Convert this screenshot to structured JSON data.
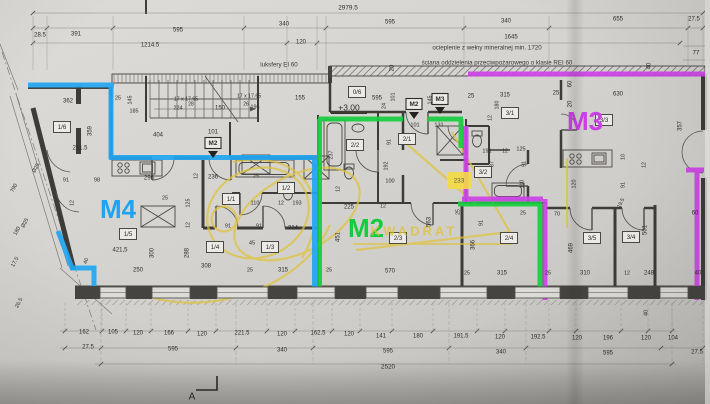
{
  "plan": {
    "colors": {
      "m4": "#1ea4f3",
      "m2": "#14cb3e",
      "m3": "#cb3fe6",
      "watermark": "#dfc33c",
      "highlight_fill": "#f4da45",
      "ink": "#2e2d2a"
    },
    "apartments": [
      {
        "t": "M4",
        "x": 118,
        "y": 211,
        "c": "#1ea4f3"
      },
      {
        "t": "M2",
        "x": 366,
        "y": 230,
        "c": "#14cb3e"
      },
      {
        "t": "M3",
        "x": 585,
        "y": 123,
        "c": "#cb3fe6"
      }
    ],
    "exit_markers": [
      {
        "t": "M2",
        "x": 213,
        "y": 143
      },
      {
        "t": "M2",
        "x": 414,
        "y": 104
      },
      {
        "t": "M3",
        "x": 440,
        "y": 99
      }
    ],
    "room_labels": [
      {
        "t": "1/6",
        "x": 62,
        "y": 127
      },
      {
        "t": "0/6",
        "x": 357,
        "y": 92
      },
      {
        "t": "2/2",
        "x": 355,
        "y": 145
      },
      {
        "t": "2/1",
        "x": 407,
        "y": 139
      },
      {
        "t": "3/1",
        "x": 510,
        "y": 113
      },
      {
        "t": "3/3",
        "x": 604,
        "y": 120
      },
      {
        "t": "3/2",
        "x": 483,
        "y": 172
      },
      {
        "t": "1/2",
        "x": 286,
        "y": 188
      },
      {
        "t": "1/1",
        "x": 231,
        "y": 199
      },
      {
        "t": "1/5",
        "x": 128,
        "y": 234
      },
      {
        "t": "1/4",
        "x": 215,
        "y": 247
      },
      {
        "t": "1/3",
        "x": 270,
        "y": 247
      },
      {
        "t": "2/3",
        "x": 398,
        "y": 238
      },
      {
        "t": "2/4",
        "x": 509,
        "y": 238
      },
      {
        "t": "3/5",
        "x": 592,
        "y": 238
      },
      {
        "t": "3/4",
        "x": 631,
        "y": 237
      }
    ],
    "notes": [
      {
        "t": "ocieplenie z wełny mineralnej min. 1720",
        "x": 487,
        "y": 48
      },
      {
        "t": "ściana oddzielenia przeciwpożarowego o klasie  REI 60",
        "x": 497,
        "y": 63
      },
      {
        "t": "luksfery EI 60",
        "x": 279,
        "y": 65
      }
    ],
    "level_mark": {
      "t": "+3.00",
      "x": 349,
      "y": 108
    },
    "watermark_text": {
      "t": "KWADRAT",
      "x": 414,
      "y": 232
    },
    "highlight_box": {
      "t": "233",
      "x": 459,
      "y": 181
    },
    "section_marker": {
      "t": "A",
      "x": 192,
      "y": 397
    },
    "dimensions": [
      {
        "t": "2979.5",
        "x": 348,
        "y": 8,
        "s": 6.4
      },
      {
        "t": "28.5",
        "x": 40,
        "y": 35
      },
      {
        "t": "391",
        "x": 76,
        "y": 34
      },
      {
        "t": "595",
        "x": 178,
        "y": 30
      },
      {
        "t": "340",
        "x": 284,
        "y": 24
      },
      {
        "t": "595",
        "x": 390,
        "y": 22
      },
      {
        "t": "340",
        "x": 506,
        "y": 21
      },
      {
        "t": "655",
        "x": 618,
        "y": 19
      },
      {
        "t": "27.5",
        "x": 694,
        "y": 19
      },
      {
        "t": "1214.5",
        "x": 150,
        "y": 45
      },
      {
        "t": "120",
        "x": 301,
        "y": 42
      },
      {
        "t": "1645",
        "x": 511,
        "y": 37
      },
      {
        "t": "77",
        "x": 696,
        "y": 53
      },
      {
        "t": "20",
        "x": 392,
        "y": 68,
        "r": -90
      },
      {
        "t": "155",
        "x": 300,
        "y": 98
      },
      {
        "t": "17 x 17.65",
        "x": 186,
        "y": 99,
        "s": 5.2
      },
      {
        "t": "224",
        "x": 178,
        "y": 108,
        "s": 5.4
      },
      {
        "t": "28",
        "x": 191,
        "y": 104,
        "s": 5
      },
      {
        "t": "17 x 17.65",
        "x": 249,
        "y": 96,
        "s": 5.2
      },
      {
        "t": "26",
        "x": 246,
        "y": 104,
        "s": 5
      },
      {
        "t": "196",
        "x": 255,
        "y": 107,
        "s": 5.4
      },
      {
        "t": "150",
        "x": 220,
        "y": 108
      },
      {
        "t": "362",
        "x": 68,
        "y": 101
      },
      {
        "t": "25",
        "x": 118,
        "y": 98,
        "s": 5.4
      },
      {
        "t": "145",
        "x": 130,
        "y": 100,
        "r": -90,
        "s": 5.4
      },
      {
        "t": "185",
        "x": 134,
        "y": 111,
        "s": 5.4
      },
      {
        "t": "359",
        "x": 90,
        "y": 131,
        "r": -90
      },
      {
        "t": "261.5",
        "x": 80,
        "y": 148
      },
      {
        "t": "404",
        "x": 158,
        "y": 135
      },
      {
        "t": "101",
        "x": 213,
        "y": 132
      },
      {
        "t": "595",
        "x": 377,
        "y": 98
      },
      {
        "t": "24",
        "x": 384,
        "y": 106,
        "r": -90,
        "s": 5.4
      },
      {
        "t": "101",
        "x": 393,
        "y": 97,
        "r": -90,
        "s": 5.4
      },
      {
        "t": "145",
        "x": 430,
        "y": 100,
        "r": -90,
        "s": 5.4
      },
      {
        "t": "25",
        "x": 471,
        "y": 96
      },
      {
        "t": "315",
        "x": 505,
        "y": 95
      },
      {
        "t": "25",
        "x": 556,
        "y": 93
      },
      {
        "t": "630",
        "x": 618,
        "y": 94
      },
      {
        "t": "60",
        "x": 570,
        "y": 84,
        "r": -90
      },
      {
        "t": "40",
        "x": 649,
        "y": 66,
        "r": -90
      },
      {
        "t": "20",
        "x": 570,
        "y": 104,
        "r": -90
      },
      {
        "t": "357",
        "x": 680,
        "y": 126,
        "r": -90
      },
      {
        "t": "12",
        "x": 490,
        "y": 118,
        "r": -90,
        "s": 5.2
      },
      {
        "t": "180",
        "x": 497,
        "y": 105,
        "r": -90,
        "s": 5.2
      },
      {
        "t": "191",
        "x": 487,
        "y": 151,
        "s": 5.6
      },
      {
        "t": "12",
        "x": 505,
        "y": 151,
        "s": 5.2
      },
      {
        "t": "125",
        "x": 521,
        "y": 149,
        "s": 5.6
      },
      {
        "t": "87",
        "x": 492,
        "y": 164,
        "r": -90,
        "s": 5.2
      },
      {
        "t": "91",
        "x": 524,
        "y": 164,
        "r": -90,
        "s": 5.4
      },
      {
        "t": "110",
        "x": 522,
        "y": 184,
        "r": -90,
        "s": 5.4
      },
      {
        "t": "10",
        "x": 623,
        "y": 157,
        "r": -90,
        "s": 5.4
      },
      {
        "t": "12",
        "x": 644,
        "y": 165,
        "r": -90,
        "s": 5.2
      },
      {
        "t": "91",
        "x": 623,
        "y": 185,
        "r": -90,
        "s": 5.4
      },
      {
        "t": "19.5",
        "x": 621,
        "y": 203,
        "r": -63,
        "s": 5.2
      },
      {
        "t": "120",
        "x": 574,
        "y": 184,
        "r": -90,
        "s": 5.4
      },
      {
        "t": "91",
        "x": 66,
        "y": 180,
        "s": 5.6
      },
      {
        "t": "98",
        "x": 97,
        "y": 180,
        "s": 5.6
      },
      {
        "t": "12",
        "x": 72,
        "y": 203,
        "r": -90,
        "s": 5.2
      },
      {
        "t": "296",
        "x": 149,
        "y": 178
      },
      {
        "t": "12",
        "x": 196,
        "y": 176,
        "r": -90,
        "s": 5.2
      },
      {
        "t": "236",
        "x": 213,
        "y": 177
      },
      {
        "t": "25",
        "x": 165,
        "y": 198,
        "s": 5.4
      },
      {
        "t": "25",
        "x": 256,
        "y": 176,
        "s": 5.4
      },
      {
        "t": "125",
        "x": 188,
        "y": 203,
        "r": -90,
        "s": 5.4
      },
      {
        "t": "12",
        "x": 188,
        "y": 225,
        "r": -90,
        "s": 5.2
      },
      {
        "t": "288",
        "x": 187,
        "y": 253,
        "r": -90
      },
      {
        "t": "91",
        "x": 228,
        "y": 226,
        "s": 5.6
      },
      {
        "t": "91",
        "x": 259,
        "y": 226,
        "s": 5.6
      },
      {
        "t": "45",
        "x": 252,
        "y": 243,
        "s": 5.6
      },
      {
        "t": "214",
        "x": 293,
        "y": 228
      },
      {
        "t": "110",
        "x": 255,
        "y": 203,
        "s": 5.6
      },
      {
        "t": "12",
        "x": 281,
        "y": 203,
        "s": 5.2
      },
      {
        "t": "193",
        "x": 297,
        "y": 203,
        "s": 5.6
      },
      {
        "t": "421,5",
        "x": 120,
        "y": 250
      },
      {
        "t": "250",
        "x": 138,
        "y": 270
      },
      {
        "t": "300",
        "x": 152,
        "y": 253,
        "r": -90
      },
      {
        "t": "40",
        "x": 86,
        "y": 261,
        "r": -68,
        "s": 5.4
      },
      {
        "t": "308",
        "x": 206,
        "y": 266
      },
      {
        "t": "25",
        "x": 250,
        "y": 270,
        "s": 5.4
      },
      {
        "t": "315",
        "x": 283,
        "y": 270
      },
      {
        "t": "25",
        "x": 329,
        "y": 270,
        "s": 5.4
      },
      {
        "t": "570",
        "x": 390,
        "y": 271
      },
      {
        "t": "237",
        "x": 331,
        "y": 155,
        "r": -90,
        "s": 5.4
      },
      {
        "t": "12",
        "x": 338,
        "y": 189,
        "r": -90,
        "s": 5.2
      },
      {
        "t": "91",
        "x": 389,
        "y": 142,
        "r": -90,
        "s": 5.4
      },
      {
        "t": "192",
        "x": 386,
        "y": 166,
        "r": -90,
        "s": 5.4
      },
      {
        "t": "100",
        "x": 390,
        "y": 181,
        "s": 5.6
      },
      {
        "t": "225",
        "x": 349,
        "y": 207
      },
      {
        "t": "12",
        "x": 383,
        "y": 206,
        "s": 5.2
      },
      {
        "t": "451",
        "x": 338,
        "y": 237,
        "r": -90
      },
      {
        "t": "563",
        "x": 429,
        "y": 222,
        "r": -90
      },
      {
        "t": "101",
        "x": 415,
        "y": 125,
        "s": 5.6
      },
      {
        "t": "131",
        "x": 439,
        "y": 125,
        "s": 5.6
      },
      {
        "t": "366",
        "x": 473,
        "y": 245,
        "r": -90
      },
      {
        "t": "91",
        "x": 481,
        "y": 223,
        "r": -90,
        "s": 5.4
      },
      {
        "t": "25",
        "x": 458,
        "y": 212,
        "r": -90,
        "s": 5.2
      },
      {
        "t": "70",
        "x": 557,
        "y": 214,
        "s": 5.6
      },
      {
        "t": "25",
        "x": 523,
        "y": 213,
        "s": 5.4
      },
      {
        "t": "469",
        "x": 571,
        "y": 248,
        "r": -90
      },
      {
        "t": "501",
        "x": 645,
        "y": 230,
        "r": -90
      },
      {
        "t": "60",
        "x": 695,
        "y": 213
      },
      {
        "t": "40",
        "x": 698,
        "y": 273
      },
      {
        "t": "25",
        "x": 467,
        "y": 273,
        "s": 5.4
      },
      {
        "t": "315",
        "x": 502,
        "y": 273
      },
      {
        "t": "25",
        "x": 548,
        "y": 273,
        "s": 5.4
      },
      {
        "t": "310",
        "x": 585,
        "y": 273
      },
      {
        "t": "12",
        "x": 627,
        "y": 273,
        "s": 5.2
      },
      {
        "t": "248",
        "x": 649,
        "y": 273
      },
      {
        "t": "40",
        "x": 646,
        "y": 313,
        "r": -90,
        "s": 5.4
      },
      {
        "t": "162",
        "x": 84,
        "y": 332
      },
      {
        "t": "105",
        "x": 113,
        "y": 332
      },
      {
        "t": "120",
        "x": 138,
        "y": 333
      },
      {
        "t": "166",
        "x": 169,
        "y": 333
      },
      {
        "t": "120",
        "x": 202,
        "y": 334
      },
      {
        "t": "221.5",
        "x": 242,
        "y": 333
      },
      {
        "t": "120",
        "x": 282,
        "y": 334
      },
      {
        "t": "162.5",
        "x": 318,
        "y": 333
      },
      {
        "t": "120",
        "x": 349,
        "y": 334
      },
      {
        "t": "141",
        "x": 381,
        "y": 336
      },
      {
        "t": "180",
        "x": 418,
        "y": 336
      },
      {
        "t": "191.5",
        "x": 461,
        "y": 336
      },
      {
        "t": "120",
        "x": 500,
        "y": 337
      },
      {
        "t": "192.5",
        "x": 538,
        "y": 337
      },
      {
        "t": "120",
        "x": 577,
        "y": 338
      },
      {
        "t": "196",
        "x": 608,
        "y": 338
      },
      {
        "t": "120",
        "x": 646,
        "y": 338
      },
      {
        "t": "104",
        "x": 673,
        "y": 338
      },
      {
        "t": "27.5",
        "x": 88,
        "y": 347
      },
      {
        "t": "595",
        "x": 173,
        "y": 349
      },
      {
        "t": "340",
        "x": 282,
        "y": 350
      },
      {
        "t": "595",
        "x": 388,
        "y": 351
      },
      {
        "t": "340",
        "x": 501,
        "y": 352
      },
      {
        "t": "595",
        "x": 608,
        "y": 353
      },
      {
        "t": "27.5",
        "x": 697,
        "y": 352
      },
      {
        "t": "2520",
        "x": 388,
        "y": 367,
        "s": 6.4
      },
      {
        "t": "790",
        "x": 14,
        "y": 188,
        "r": -62,
        "s": 5.4
      },
      {
        "t": "180",
        "x": 17,
        "y": 231,
        "r": -62,
        "s": 5.4
      },
      {
        "t": "Ø25",
        "x": 36,
        "y": 168,
        "r": -62,
        "s": 5.4
      },
      {
        "t": "Ø25",
        "x": 25,
        "y": 223,
        "r": -62,
        "s": 5.4
      },
      {
        "t": "17.5",
        "x": 15,
        "y": 262,
        "r": -62,
        "s": 5.4
      },
      {
        "t": "26.5",
        "x": 19,
        "y": 303,
        "r": -62,
        "s": 5.4
      }
    ]
  }
}
